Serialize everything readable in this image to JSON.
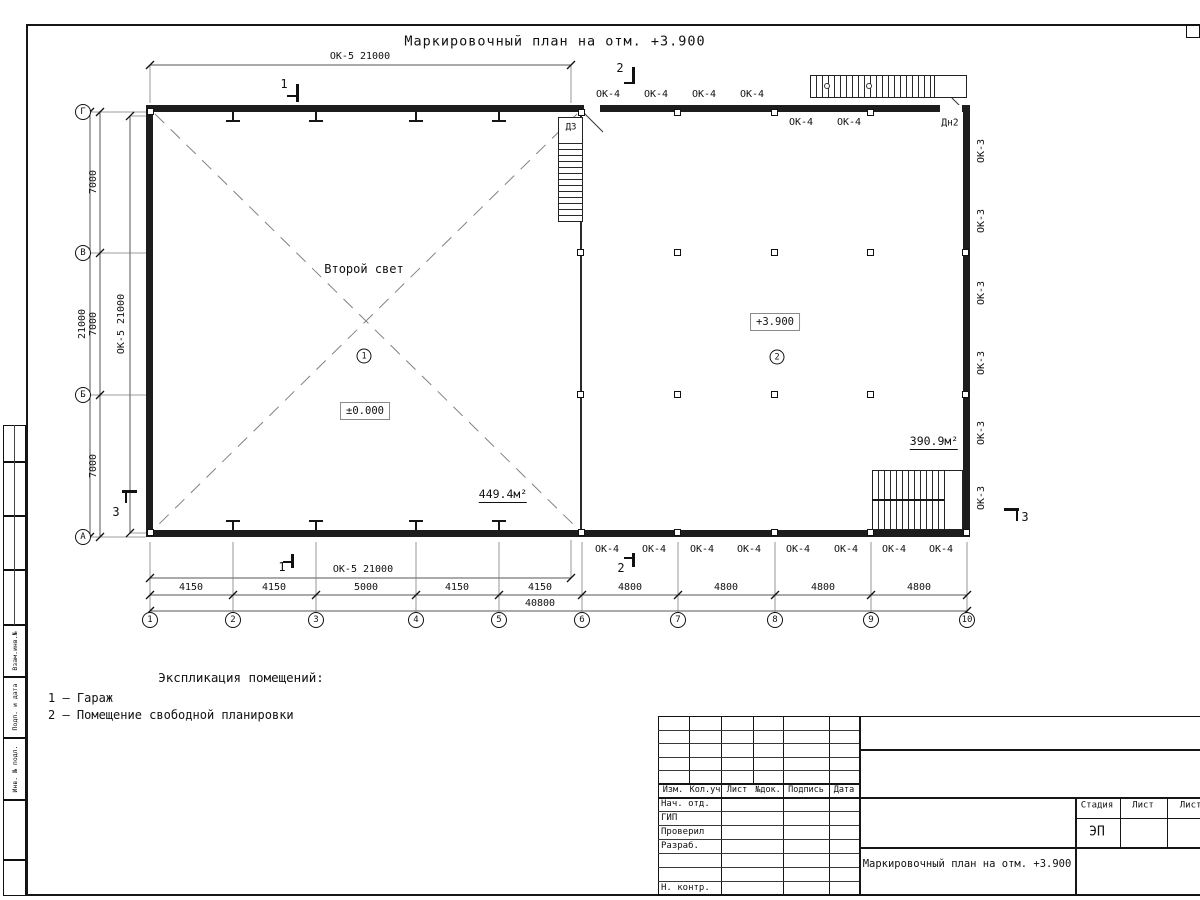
{
  "sheet": {
    "title": "Маркировочный план на отм. +3.900"
  },
  "grid": {
    "cols": [
      "1",
      "2",
      "3",
      "4",
      "5",
      "6",
      "7",
      "8",
      "9",
      "10"
    ],
    "rows": [
      "Г",
      "В",
      "Б",
      "А"
    ]
  },
  "dims": {
    "top_window": "ОК-5 21000",
    "bottom_window": "ОК-5 21000",
    "left_window": "ОК-5 21000",
    "left_spans": [
      "7000",
      "7000",
      "7000"
    ],
    "left_total": "21000",
    "bottom_left": [
      "4150",
      "4150",
      "5000",
      "4150",
      "4150"
    ],
    "bottom_right": [
      "4800",
      "4800",
      "4800",
      "4800"
    ],
    "total": "40800"
  },
  "windows": {
    "ok4": "ОК-4",
    "ok3": "ОК-3"
  },
  "doors": {
    "d3": "Д3",
    "dn2": "Дн2"
  },
  "rooms": {
    "r1": {
      "number": "1",
      "name": "Второй свет",
      "level": "±0.000",
      "area": "449.4м²"
    },
    "r2": {
      "number": "2",
      "level": "+3.900",
      "area": "390.9м²"
    }
  },
  "sections": {
    "s1": "1",
    "s2": "2",
    "s3": "3"
  },
  "explication": {
    "heading": "Экспликация помещений:",
    "items": [
      "1 – Гараж",
      "2 – Помещение свободной планировки"
    ]
  },
  "frame": {
    "labels": [
      "Взам.инв.№",
      "Подп. и дата",
      "Инв. № подл."
    ]
  },
  "titleblock": {
    "rev_cols": [
      "Изм.",
      "Кол.уч",
      "Лист",
      "№док.",
      "Подпись",
      "Дата"
    ],
    "roles": [
      "Нач. отд.",
      "ГИП",
      "Проверил",
      "Разраб.",
      "Н. контр."
    ],
    "stage_cols": [
      "Стадия",
      "Лист",
      "Листов"
    ],
    "stage": "ЭП",
    "doc_title": "Маркировочный план на отм. +3.900"
  }
}
